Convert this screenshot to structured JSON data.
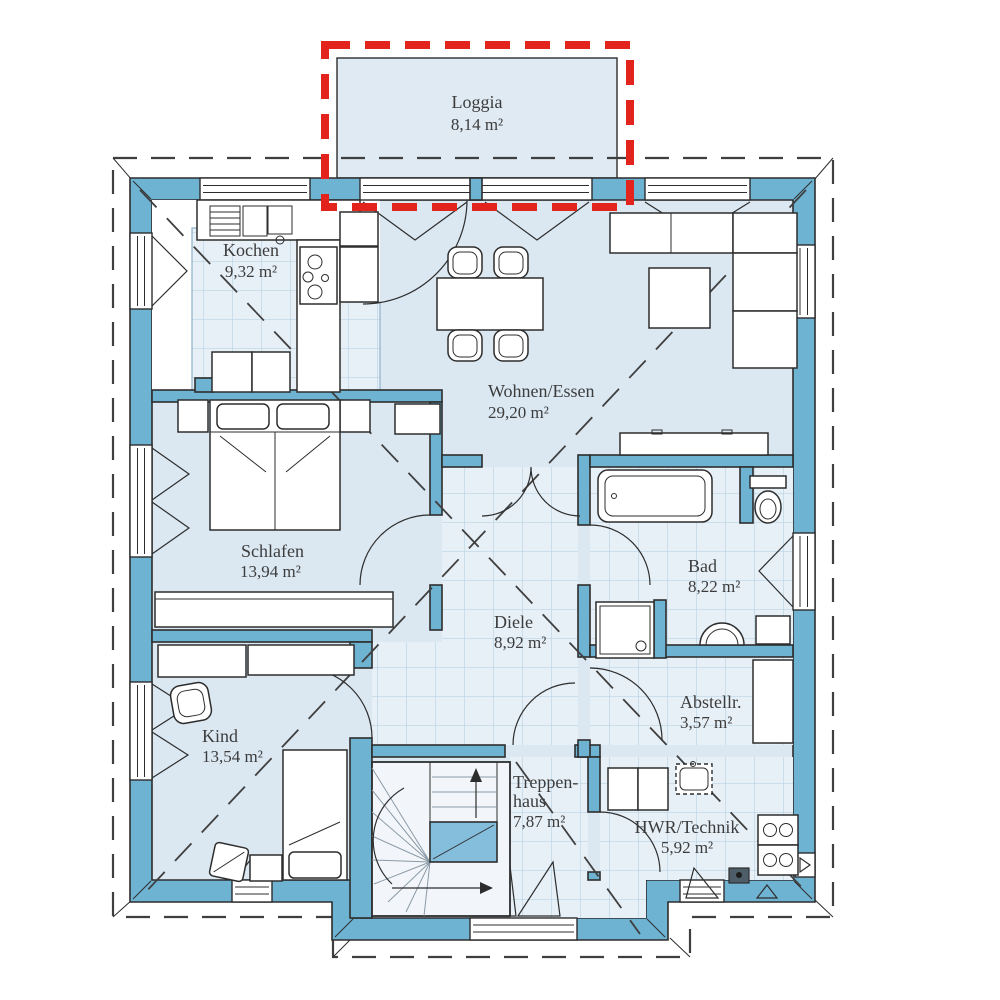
{
  "plan": {
    "type": "floor-plan",
    "unit": "m²",
    "rooms": [
      {
        "id": "loggia",
        "name": "Loggia",
        "area": "8,14 m²"
      },
      {
        "id": "kochen",
        "name": "Kochen",
        "area": "9,32 m²"
      },
      {
        "id": "wohnen",
        "name": "Wohnen/Essen",
        "area": "29,20 m²"
      },
      {
        "id": "schlafen",
        "name": "Schlafen",
        "area": "13,94 m²"
      },
      {
        "id": "bad",
        "name": "Bad",
        "area": "8,22 m²"
      },
      {
        "id": "diele",
        "name": "Diele",
        "area": "8,92 m²"
      },
      {
        "id": "kind",
        "name": "Kind",
        "area": "13,54 m²"
      },
      {
        "id": "treppenhaus",
        "name": "Treppen-",
        "name_wrap": "haus",
        "area": "7,87 m²"
      },
      {
        "id": "hwr",
        "name": "HWR/Technik",
        "area": "5,92 m²"
      },
      {
        "id": "abstellraum",
        "name": "Abstellr.",
        "area": "3,57 m²"
      }
    ],
    "colors": {
      "wall": "#6fb3d3",
      "outline": "#2d2d2d",
      "floor": "#dbe8f2",
      "tile_base": "#e7f0f7",
      "tile_line": "#bad3e4",
      "loggia_fill": "#dfeaf2",
      "stair_floor": "#f2f6fa",
      "stair_landing": "#85bedd",
      "highlight_red": "#e2241c",
      "label_text": "#3c3c3c",
      "tread": "#8a9aa6",
      "white": "#ffffff"
    }
  }
}
